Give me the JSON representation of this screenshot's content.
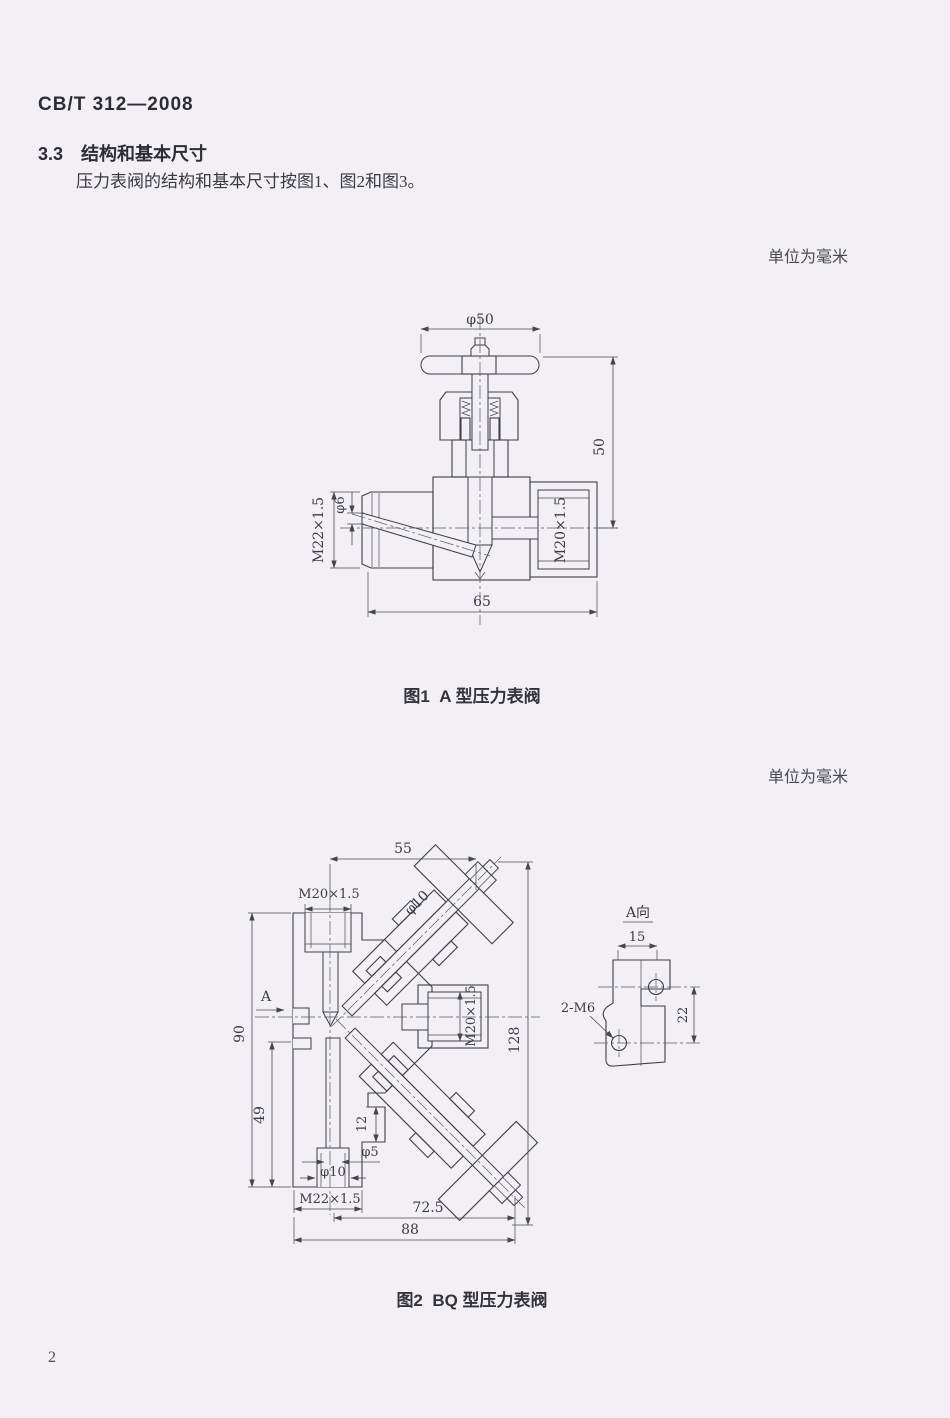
{
  "page": {
    "header": "CB/T 312—2008",
    "section": {
      "number": "3.3",
      "title": "结构和基本尺寸"
    },
    "paragraph": "压力表阀的结构和基本尺寸按图1、图2和图3。",
    "page_number": "2"
  },
  "figure1": {
    "units_note": "单位为毫米",
    "caption": "图1  A 型压力表阀",
    "labels": {
      "handwheel_dia": "φ50",
      "height_50": "50",
      "thread_m22": "M22×1.5",
      "dia_6": "φ6",
      "thread_m20": "M20×1.5",
      "width_65": "65"
    }
  },
  "figure2": {
    "units_note": "单位为毫米",
    "caption": "图2  BQ 型压力表阀",
    "labels": {
      "width_55": "55",
      "thread_m20_top": "M20×1.5",
      "dia_10_stem": "φ10",
      "view_arrow": "A",
      "height_90": "90",
      "height_49": "49",
      "step_12": "12",
      "dia_5": "φ5",
      "dia_10_bottom": "φ10",
      "thread_m22_bottom": "M22×1.5",
      "width_72_5": "72.5",
      "width_88": "88",
      "height_128": "128",
      "thread_m20_right": "M20×1.5"
    },
    "aview": {
      "title": "A向",
      "width_15": "15",
      "holes_2m6": "2-M6",
      "spacing_22": "22"
    }
  }
}
